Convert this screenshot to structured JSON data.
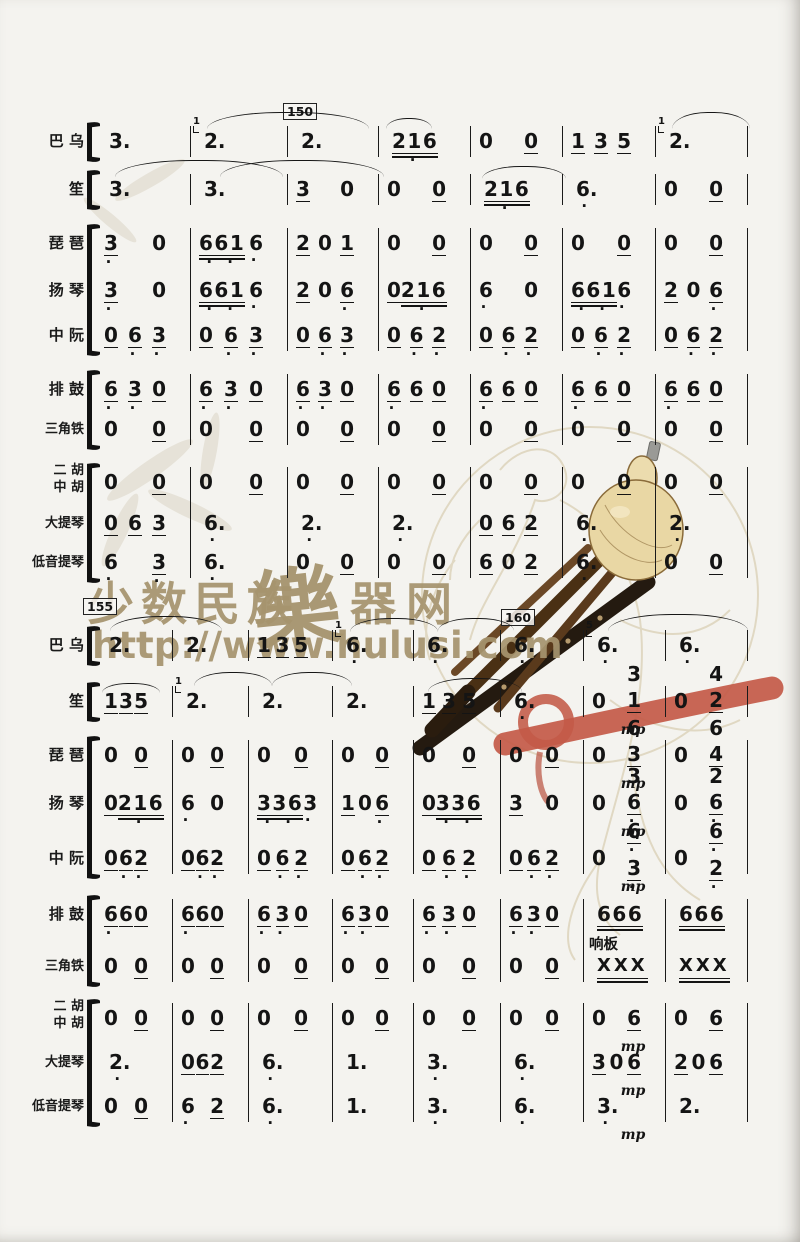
{
  "watermark": {
    "title_left": "少数民族",
    "title_script": "樂",
    "title_right": "器网",
    "url": "http://www.hulusi.com",
    "color": "#a6946e",
    "brush_color": "#c35a48"
  },
  "rehearsal_marks": [
    "150",
    "155",
    "160"
  ],
  "percussion_label": "响板",
  "dynamic": "mp",
  "instruments": [
    {
      "id": "bawu",
      "label": "巴 乌"
    },
    {
      "id": "sheng",
      "label": "笙"
    },
    {
      "id": "pipa",
      "label": "琵 琶"
    },
    {
      "id": "yangqin",
      "label": "扬 琴"
    },
    {
      "id": "zhongruan",
      "label": "中 阮"
    },
    {
      "id": "paigu",
      "label": "排 鼓"
    },
    {
      "id": "sanjiaotie",
      "label": "三角铁"
    },
    {
      "id": "erhu-zhonghu",
      "label": "二 胡|中 胡"
    },
    {
      "id": "datiqin",
      "label": "大提琴"
    },
    {
      "id": "diyintiqin",
      "label": "低音提琴"
    }
  ],
  "systems": [
    {
      "rehearsal": "150",
      "rows": [
        {
          "inst": 0,
          "measures": [
            {
              "notes": [
                "3."
              ]
            },
            {
              "notes": [
                "g1 2."
              ]
            },
            {
              "notes": [
                "2."
              ]
            },
            {
              "notes": [
                "216=*"
              ]
            },
            {
              "notes": [
                "0",
                "0_"
              ]
            },
            {
              "notes": [
                "1_",
                "3_",
                "5_"
              ]
            },
            {
              "notes": [
                "g1 2."
              ]
            }
          ]
        },
        {
          "inst": 1,
          "measures": [
            {
              "notes": [
                "3."
              ]
            },
            {
              "notes": [
                "3."
              ]
            },
            {
              "notes": [
                "3_",
                "0"
              ]
            },
            {
              "notes": [
                "0",
                "0_"
              ]
            },
            {
              "notes": [
                "216=*"
              ]
            },
            {
              "notes": [
                "6.*"
              ]
            },
            {
              "notes": [
                "0",
                "0_"
              ]
            }
          ]
        },
        {
          "inst": 2,
          "measures": [
            {
              "notes": [
                "3_*",
                "0"
              ]
            },
            {
              "notes": [
                "661=**",
                "6*"
              ]
            },
            {
              "notes": [
                "2_",
                "0",
                "1_"
              ]
            },
            {
              "notes": [
                "0",
                "0_"
              ]
            },
            {
              "notes": [
                "0",
                "0_"
              ]
            },
            {
              "notes": [
                "0",
                "0_"
              ]
            },
            {
              "notes": [
                "0",
                "0_"
              ]
            }
          ]
        },
        {
          "inst": 3,
          "measures": [
            {
              "notes": [
                "3_*",
                "0"
              ]
            },
            {
              "notes": [
                "661=**",
                "6*"
              ]
            },
            {
              "notes": [
                "2_",
                "0",
                "6_*"
              ]
            },
            {
              "notes": [
                "0_",
                "216=*"
              ]
            },
            {
              "notes": [
                "6*",
                "0"
              ]
            },
            {
              "notes": [
                "661=**",
                "6*"
              ]
            },
            {
              "notes": [
                "2_",
                "0",
                "6_*"
              ]
            }
          ]
        },
        {
          "inst": 4,
          "measures": [
            {
              "notes": [
                "0_",
                "6_*",
                "3_*"
              ]
            },
            {
              "notes": [
                "0_",
                "6_*",
                "3_*"
              ]
            },
            {
              "notes": [
                "0_",
                "6_*",
                "3_*"
              ]
            },
            {
              "notes": [
                "0_",
                "6_*",
                "2_*"
              ]
            },
            {
              "notes": [
                "0_",
                "6_*",
                "2_*"
              ]
            },
            {
              "notes": [
                "0_",
                "6_*",
                "2_*"
              ]
            },
            {
              "notes": [
                "0_",
                "6_*",
                "2_*"
              ]
            }
          ]
        },
        {
          "inst": 5,
          "measures": [
            {
              "notes": [
                "6_*",
                "3_*",
                "0_"
              ]
            },
            {
              "notes": [
                "6_*",
                "3_*",
                "0_"
              ]
            },
            {
              "notes": [
                "6_*",
                "3_*",
                "0_"
              ]
            },
            {
              "notes": [
                "6_*",
                "6_",
                "0_"
              ]
            },
            {
              "notes": [
                "6_*",
                "6_",
                "0_"
              ]
            },
            {
              "notes": [
                "6_*",
                "6_",
                "0_"
              ]
            },
            {
              "notes": [
                "6_*",
                "6_",
                "0_"
              ]
            }
          ]
        },
        {
          "inst": 6,
          "measures": [
            {
              "notes": [
                "0",
                "0_"
              ]
            },
            {
              "notes": [
                "0",
                "0_"
              ]
            },
            {
              "notes": [
                "0",
                "0_"
              ]
            },
            {
              "notes": [
                "0",
                "0_"
              ]
            },
            {
              "notes": [
                "0",
                "0_"
              ]
            },
            {
              "notes": [
                "0",
                "0_"
              ]
            },
            {
              "notes": [
                "0",
                "0_"
              ]
            }
          ]
        },
        {
          "inst": 7,
          "measures": [
            {
              "notes": [
                "0",
                "0_"
              ]
            },
            {
              "notes": [
                "0",
                "0_"
              ]
            },
            {
              "notes": [
                "0",
                "0_"
              ]
            },
            {
              "notes": [
                "0",
                "0_"
              ]
            },
            {
              "notes": [
                "0",
                "0_"
              ]
            },
            {
              "notes": [
                "0",
                "0_"
              ]
            },
            {
              "notes": [
                "0",
                "0_"
              ]
            }
          ]
        },
        {
          "inst": 8,
          "measures": [
            {
              "notes": [
                "0_",
                "6_",
                "3_"
              ]
            },
            {
              "notes": [
                "6.*"
              ]
            },
            {
              "notes": [
                "2.*"
              ]
            },
            {
              "notes": [
                "2.*"
              ]
            },
            {
              "notes": [
                "0_",
                "6_",
                "2_"
              ]
            },
            {
              "notes": [
                "6.*"
              ]
            },
            {
              "notes": [
                "2.*"
              ]
            }
          ]
        },
        {
          "inst": 9,
          "measures": [
            {
              "notes": [
                "6*",
                "3_*"
              ]
            },
            {
              "notes": [
                "6.*"
              ]
            },
            {
              "notes": [
                "0",
                "0_"
              ]
            },
            {
              "notes": [
                "0",
                "0_"
              ]
            },
            {
              "notes": [
                "6_",
                "0",
                "2_"
              ]
            },
            {
              "notes": [
                "6.*"
              ]
            },
            {
              "notes": [
                "0",
                "0_"
              ]
            }
          ]
        }
      ]
    },
    {
      "rehearsal_start": "155",
      "rehearsal_mid": "160",
      "rows": [
        {
          "inst": 0,
          "measures": [
            {
              "notes": [
                "2."
              ]
            },
            {
              "notes": [
                "2."
              ]
            },
            {
              "notes": [
                "1_",
                "3_",
                "5_"
              ]
            },
            {
              "notes": [
                "g1 6.*"
              ]
            },
            {
              "notes": [
                "6.*"
              ]
            },
            {
              "notes": [
                "6.*"
              ]
            },
            {
              "notes": [
                "g5 6.*"
              ]
            },
            {
              "notes": [
                "6.*"
              ]
            }
          ]
        },
        {
          "inst": 1,
          "measures": [
            {
              "notes": [
                "1_",
                "3_",
                "5_"
              ]
            },
            {
              "notes": [
                "g1 2."
              ]
            },
            {
              "notes": [
                "2."
              ]
            },
            {
              "notes": [
                "2."
              ]
            },
            {
              "notes": [
                "1_",
                "3_",
                "5_"
              ]
            },
            {
              "notes": [
                "6.*"
              ]
            },
            {
              "notes": [
                "0",
                "3/1_"
              ],
              "dyn": "mp"
            },
            {
              "notes": [
                "0",
                "4/2_"
              ]
            }
          ]
        },
        {
          "inst": 2,
          "measures": [
            {
              "notes": [
                "0",
                "0_"
              ]
            },
            {
              "notes": [
                "0",
                "0_"
              ]
            },
            {
              "notes": [
                "0",
                "0_"
              ]
            },
            {
              "notes": [
                "0",
                "0_"
              ]
            },
            {
              "notes": [
                "0",
                "0_"
              ]
            },
            {
              "notes": [
                "0",
                "0_"
              ]
            },
            {
              "notes": [
                "0",
                "6/3_"
              ],
              "dyn": "mp"
            },
            {
              "notes": [
                "0",
                "6/4_"
              ]
            }
          ]
        },
        {
          "inst": 3,
          "measures": [
            {
              "notes": [
                "0_",
                "216=*"
              ]
            },
            {
              "notes": [
                "6*",
                "0"
              ]
            },
            {
              "notes": [
                "336=**",
                "3*"
              ]
            },
            {
              "notes": [
                "1_",
                "0",
                "6_*"
              ]
            },
            {
              "notes": [
                "0_",
                "336=**"
              ]
            },
            {
              "notes": [
                "3_",
                "0"
              ]
            },
            {
              "notes": [
                "0",
                "3/6_*"
              ],
              "dyn": "mp"
            },
            {
              "notes": [
                "0",
                "2/6_*"
              ]
            }
          ]
        },
        {
          "inst": 4,
          "measures": [
            {
              "notes": [
                "0_",
                "6_*",
                "2_*"
              ]
            },
            {
              "notes": [
                "0_",
                "6_*",
                "2_*"
              ]
            },
            {
              "notes": [
                "0_",
                "6_*",
                "2_*"
              ]
            },
            {
              "notes": [
                "0_",
                "6_*",
                "2_*"
              ]
            },
            {
              "notes": [
                "0_",
                "6_*",
                "2_*"
              ]
            },
            {
              "notes": [
                "0_",
                "6_*",
                "2_*"
              ]
            },
            {
              "notes": [
                "0",
                "6_*/3_*"
              ],
              "dyn": "mp"
            },
            {
              "notes": [
                "0",
                "6_*/2_*"
              ]
            }
          ]
        },
        {
          "inst": 5,
          "measures": [
            {
              "notes": [
                "6_*",
                "6_",
                "0_"
              ]
            },
            {
              "notes": [
                "6_*",
                "6_",
                "0_"
              ]
            },
            {
              "notes": [
                "6_*",
                "3_*",
                "0_"
              ]
            },
            {
              "notes": [
                "6_*",
                "3_*",
                "0_"
              ]
            },
            {
              "notes": [
                "6_*",
                "3_*",
                "0_"
              ]
            },
            {
              "notes": [
                "6_*",
                "3_*",
                "0_"
              ]
            },
            {
              "notes": [
                "666="
              ]
            },
            {
              "notes": [
                "666="
              ]
            }
          ]
        },
        {
          "inst": 6,
          "measures": [
            {
              "notes": [
                "0",
                "0_"
              ]
            },
            {
              "notes": [
                "0",
                "0_"
              ]
            },
            {
              "notes": [
                "0",
                "0_"
              ]
            },
            {
              "notes": [
                "0",
                "0_"
              ]
            },
            {
              "notes": [
                "0",
                "0_"
              ]
            },
            {
              "notes": [
                "0",
                "0_"
              ]
            },
            {
              "notes": [
                "XXX="
              ],
              "label": "响板"
            },
            {
              "notes": [
                "XXX="
              ]
            }
          ]
        },
        {
          "inst": 7,
          "measures": [
            {
              "notes": [
                "0",
                "0_"
              ]
            },
            {
              "notes": [
                "0",
                "0_"
              ]
            },
            {
              "notes": [
                "0",
                "0_"
              ]
            },
            {
              "notes": [
                "0",
                "0_"
              ]
            },
            {
              "notes": [
                "0",
                "0_"
              ]
            },
            {
              "notes": [
                "0",
                "0_"
              ]
            },
            {
              "notes": [
                "0",
                "6_"
              ],
              "dyn": "mp"
            },
            {
              "notes": [
                "0",
                "6_"
              ]
            }
          ]
        },
        {
          "inst": 8,
          "measures": [
            {
              "notes": [
                "2.*"
              ]
            },
            {
              "notes": [
                "0_",
                "6_",
                "2_"
              ]
            },
            {
              "notes": [
                "6.*"
              ]
            },
            {
              "notes": [
                "1."
              ]
            },
            {
              "notes": [
                "3.*"
              ]
            },
            {
              "notes": [
                "6.*"
              ]
            },
            {
              "notes": [
                "3_",
                "0",
                "6_"
              ],
              "dyn": "mp"
            },
            {
              "notes": [
                "2_",
                "0",
                "6_"
              ]
            }
          ]
        },
        {
          "inst": 9,
          "measures": [
            {
              "notes": [
                "0",
                "0_"
              ]
            },
            {
              "notes": [
                "6*",
                "2_"
              ]
            },
            {
              "notes": [
                "6.*"
              ]
            },
            {
              "notes": [
                "1."
              ]
            },
            {
              "notes": [
                "3.*"
              ]
            },
            {
              "notes": [
                "6.*"
              ]
            },
            {
              "notes": [
                "3.*"
              ],
              "dyn": "mp"
            },
            {
              "notes": [
                "2."
              ]
            }
          ]
        }
      ]
    }
  ]
}
